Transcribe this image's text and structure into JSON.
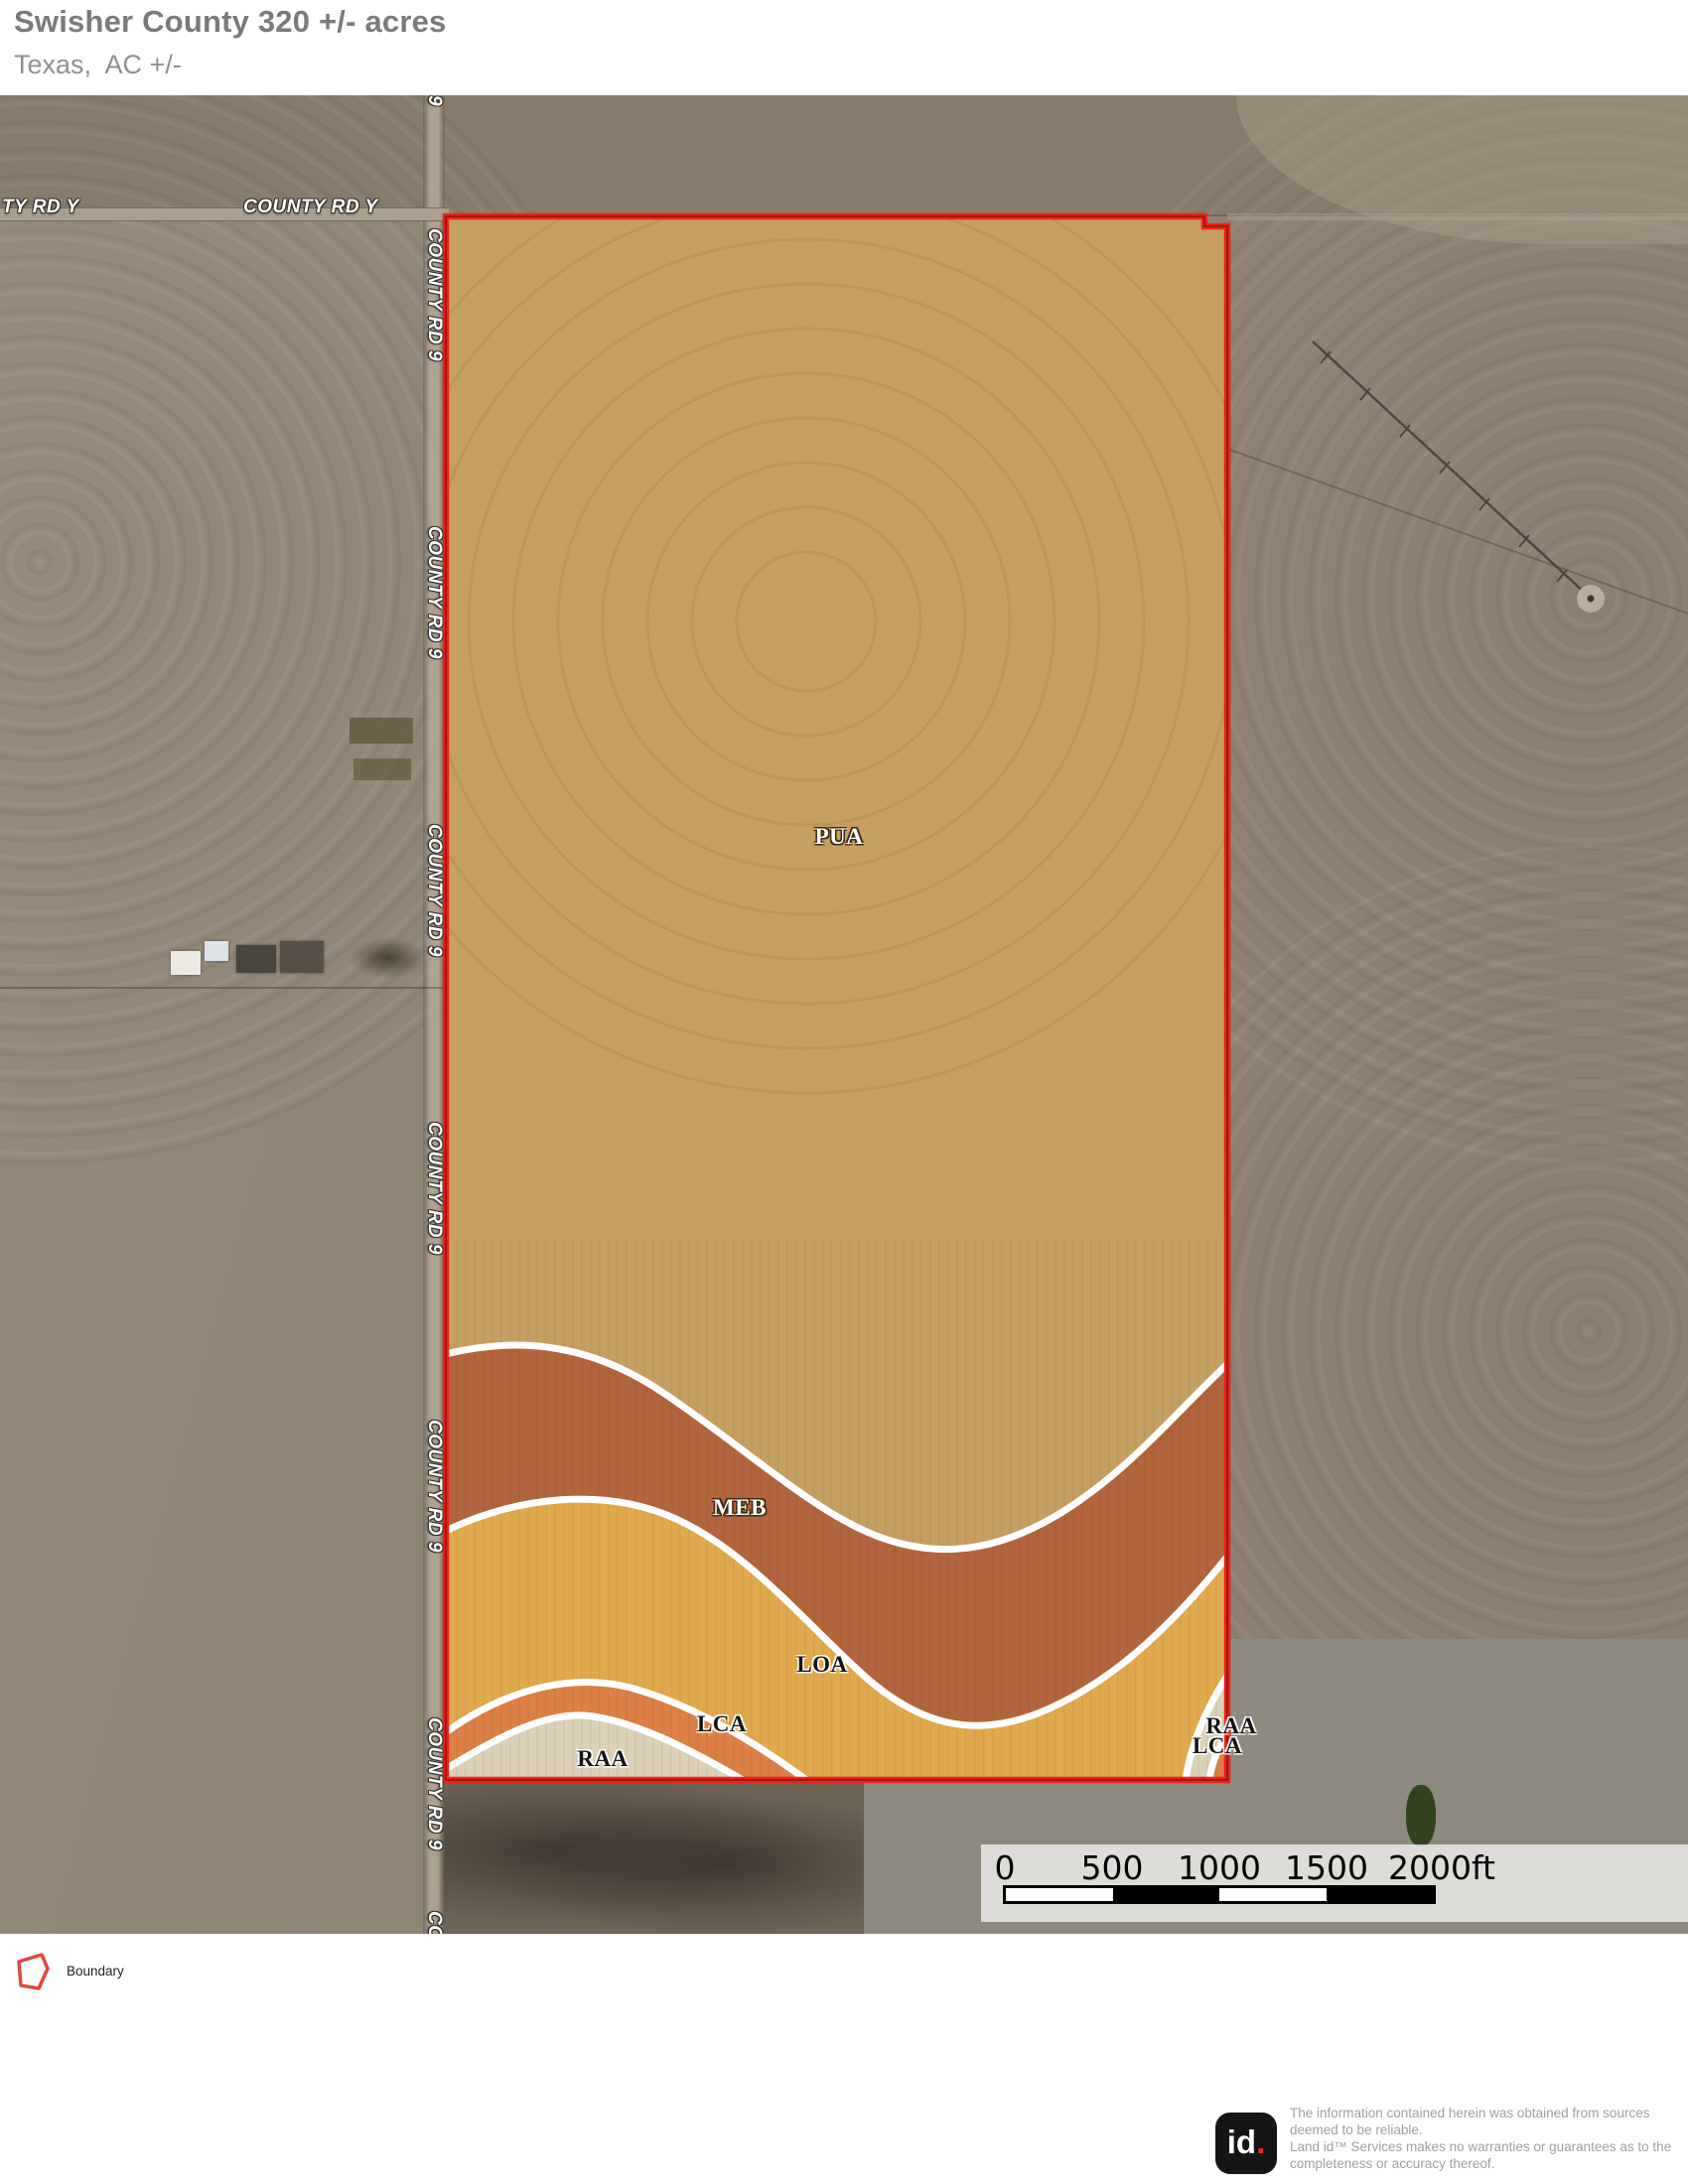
{
  "header": {
    "title": "Swisher County 320 +/- acres",
    "subtitle": "Texas,  AC +/-"
  },
  "map": {
    "road_labels": {
      "horizontal_left": "TY RD Y",
      "horizontal_right": "COUNTY RD Y",
      "vertical": "COUNTY RD 9",
      "vertical_partial_top": "9"
    },
    "soil_labels": {
      "pua": "PUA",
      "meb": "MEB",
      "loa": "LOA",
      "lca": "LCA",
      "raa": "RAA",
      "raa_right": "RAA",
      "lca_right": "LCA"
    },
    "colors": {
      "boundary_red": "#ee221b",
      "pua_tan": "#c59e61",
      "meb_sienna": "#b2643c",
      "loa_gold": "#e0a94e",
      "lca_orange": "#dc8047",
      "raa_cream": "#dbd1b7",
      "zone_divider": "#ffffff"
    }
  },
  "scalebar": {
    "ticks": [
      "0",
      "500",
      "1000",
      "1500",
      "2000ft"
    ]
  },
  "legend": {
    "boundary_label": "Boundary"
  },
  "footer": {
    "logo_text": "id",
    "logo_dot": ".",
    "lines": [
      "The information contained herein was obtained from sources",
      "deemed to be reliable.",
      " Land id™ Services makes no warranties or guarantees as to the",
      "completeness or accuracy thereof."
    ]
  }
}
